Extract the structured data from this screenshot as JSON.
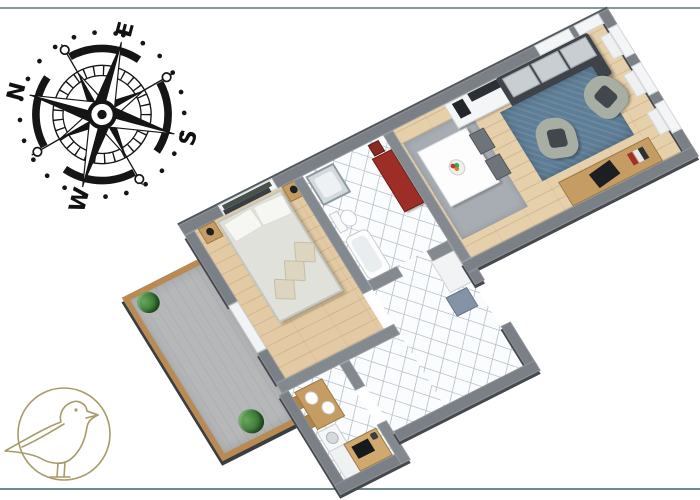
{
  "image": {
    "description": "3D isometric floor plan of an apartment, rotated, on white background",
    "background": "#ffffff"
  },
  "frame": {
    "top_line_color": "#87999b",
    "bottom_line_color": "#6f8a8c"
  },
  "compass": {
    "color": "#151515",
    "rotation_deg": -75,
    "letters": {
      "n": "N",
      "e": "E",
      "s": "S",
      "w": "W"
    }
  },
  "logo": {
    "name": "seagull-in-circle",
    "stroke_color": "#a79b69"
  },
  "floorplan": {
    "palette": {
      "wall": "#7b8087",
      "wood_floor": "#e6cfab",
      "tile_floor": "#fbfcfd",
      "balcony_deck": "#b5b7b9",
      "balcony_frame": "#b98a52",
      "sofa": "#3e434a",
      "sofa_cushions": "#c9ced3",
      "living_rug": "#5e7e97",
      "dining_rug": "#a7adb3",
      "armchair": "#a9aea4",
      "bed": "#dfe1da",
      "wood_furniture": "#c59c63",
      "red_bench": "#9c2e27",
      "plant": "#2f6b2c"
    },
    "rooms": [
      {
        "name": "living-room",
        "furniture": [
          "sofa",
          "tv-sideboard",
          "speakers",
          "blue-rug",
          "armchair",
          "armchair",
          "dining-table",
          "fruit-bowl",
          "dining-chairs",
          "desk",
          "laptop",
          "radiator-windows"
        ]
      },
      {
        "name": "bathroom",
        "furniture": [
          "shower",
          "toilet",
          "bathtub",
          "red-bench",
          "red-stool"
        ]
      },
      {
        "name": "bedroom",
        "furniture": [
          "double-bed",
          "pillows",
          "cushions",
          "nightstand-left",
          "nightstand-right",
          "lamps",
          "wall-shelf",
          "balcony-door"
        ]
      },
      {
        "name": "kitchen",
        "furniture": [
          "table",
          "plates",
          "chairs",
          "washing-machine",
          "counter",
          "cooktop"
        ]
      },
      {
        "name": "hallway",
        "furniture": [
          "white-cabinet",
          "blue-bench",
          "wooden-doors"
        ]
      },
      {
        "name": "balcony",
        "furniture": [
          "plant",
          "plant",
          "wood-deck-frame"
        ]
      }
    ]
  }
}
